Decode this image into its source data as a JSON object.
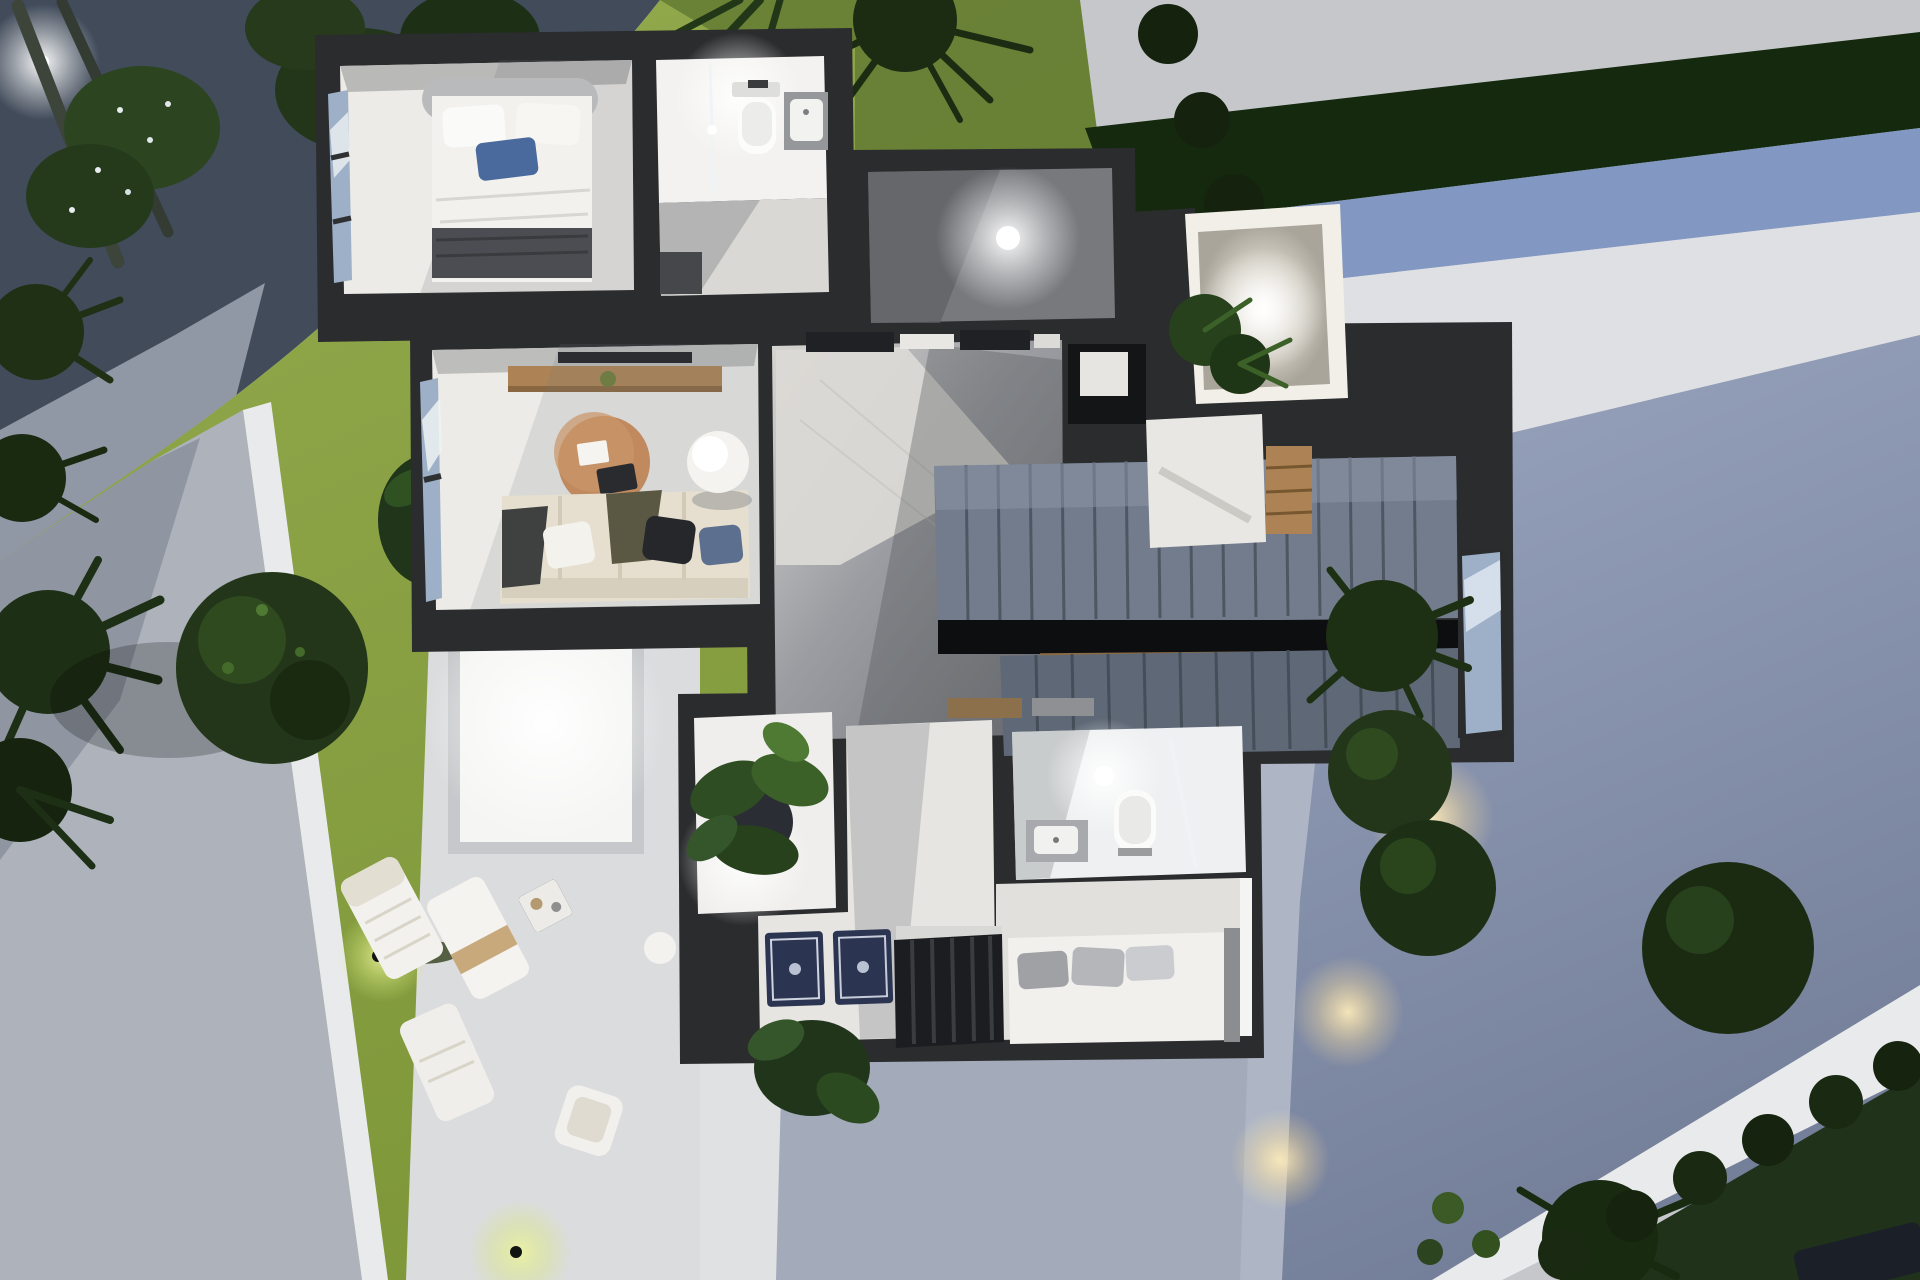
{
  "scene": {
    "kind": "3d-floorplan-render",
    "view": "top-down cutaway of modern villa upper floor with night-lit garden",
    "rooms": [
      {
        "name": "bedroom-top",
        "furniture": [
          "double-bed",
          "white-duvet",
          "blue-pillow",
          "dark-throw",
          "window-wall"
        ]
      },
      {
        "name": "bathroom-top",
        "furniture": [
          "toilet",
          "wall-sink",
          "glass-shower-screen",
          "ceiling-light"
        ]
      },
      {
        "name": "entry-room",
        "furniture": [
          "ceiling-light"
        ]
      },
      {
        "name": "courtyard-lightwell",
        "furniture": [
          "gravel-floor",
          "spotlight",
          "ferns"
        ]
      },
      {
        "name": "living-room",
        "furniture": [
          "wood-console",
          "tv",
          "round-coffee-table",
          "l-sofa",
          "hanging-chair",
          "window-wall"
        ]
      },
      {
        "name": "hallway",
        "furniture": [
          "marble-floor",
          "ceiling-beams"
        ]
      },
      {
        "name": "staircase",
        "furniture": [
          "upper-flight",
          "landing",
          "void",
          "lower-flight",
          "wood-cabinet",
          "landing-window"
        ]
      },
      {
        "name": "bathroom-lower",
        "furniture": [
          "toilet",
          "vanity-sink",
          "glass-screen",
          "ceiling-light"
        ]
      },
      {
        "name": "bedroom-lower",
        "furniture": [
          "open-wardrobe-clothes",
          "bed-gray-pillows",
          "patterned-rugs",
          "potted-plant"
        ]
      }
    ],
    "garden": [
      "gravel-corner",
      "palm-trees",
      "flowering-bushes",
      "round-tree",
      "lawn-spotlights",
      "white-boundary-wall",
      "sun-loungers",
      "side-table",
      "patio-skylight",
      "hedge-band",
      "blue-wall-band",
      "twilight-walkway",
      "path-light-pools",
      "topiary-row",
      "dark-lawn-corner"
    ]
  },
  "palette": {
    "sidewalk": "#c5c7cb",
    "gravel": "#414b5a",
    "lawn": "#8ca348",
    "lawn_shade": "#6e8833",
    "left_path": "#aeb2bb",
    "wall_white": "#e9eaec",
    "hedge": "#14290e",
    "hedge_wall_blue": "#8298c2",
    "terrace_white": "#dfe0e3",
    "twilight_path": "#8b96b0",
    "patio": "#dbdcde",
    "patio_bright": "#f5f5f4",
    "house_wall": "#2b2c2e",
    "room_floor": "#ecebe7",
    "hall_marble": "#83868c",
    "stair_tread": "#727c8c",
    "stair_tread_dark": "#5e6876",
    "wood": "#ad8355",
    "sofa": "#e6dfcf",
    "bed_white": "#f1f0ed",
    "pillow_blue": "#4a6a9e",
    "throw_dark": "#4c4d52",
    "tree": "#233619",
    "tree_dark": "#15220e",
    "plant_light": "#4e7a33",
    "rug_navy": "#2b3450",
    "glass_blue": "#9db0c8",
    "lawn_dark_corner": "#20331a",
    "glow_warm": "#ffe9b4"
  }
}
